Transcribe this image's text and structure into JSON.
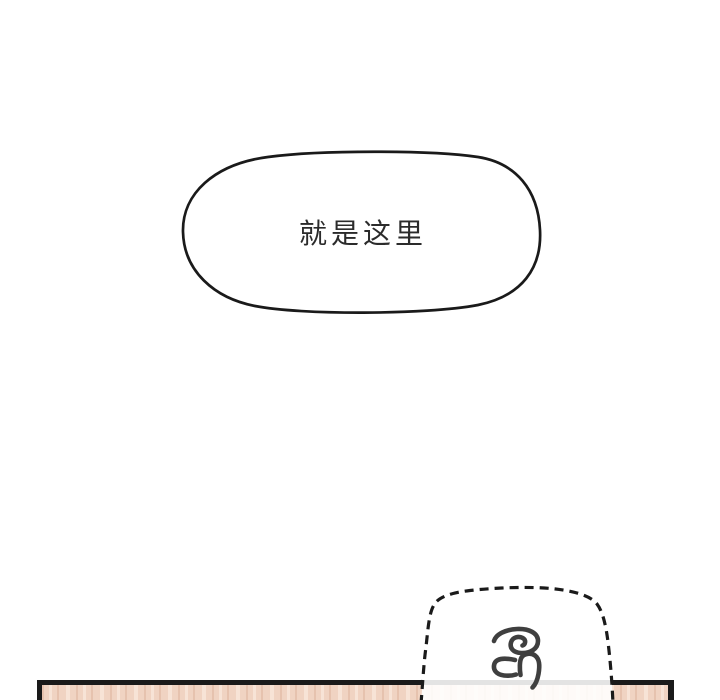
{
  "speech_bubble": {
    "text": "就是这里"
  },
  "sound_effect_bubble": {
    "glyph_character": "昂"
  },
  "colors": {
    "ink": "#1a1a1a",
    "text_ink": "#2b2b2b",
    "glyph_ink": "#3f3f3f",
    "wood_base": "#f0d3c2",
    "wood_streak_dark": "#e6c2ae",
    "wood_streak_light": "#f7e3d6",
    "page_bg": "#ffffff"
  }
}
